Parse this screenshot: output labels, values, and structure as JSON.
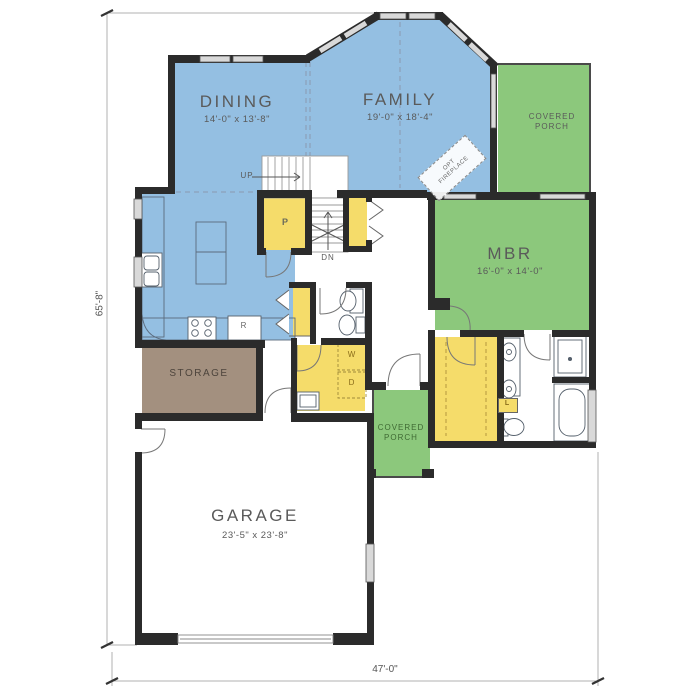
{
  "plan": {
    "rooms": {
      "dining": {
        "name": "DINING",
        "dims": "14'-0\" x 13'-8\""
      },
      "family": {
        "name": "FAMILY",
        "dims": "19'-0\" x 18'-4\""
      },
      "covered_porch_upper": {
        "name": "COVERED\nPORCH"
      },
      "covered_porch_lower": {
        "name": "COVERED\nPORCH"
      },
      "mbr": {
        "name": "MBR",
        "dims": "16'-0\" x 14'-0\""
      },
      "storage": {
        "name": "STORAGE"
      },
      "garage": {
        "name": "GARAGE",
        "dims": "23'-5\" x 23'-8\""
      }
    },
    "labels": {
      "up": "UP",
      "dn": "DN",
      "pantry": "P",
      "refrigerator": "R",
      "washer": "W",
      "dryer": "D",
      "linen": "L",
      "fireplace_line1": "OPT",
      "fireplace_line2": "FIREPLACE"
    },
    "dimensions": {
      "overall_width": "47'-0\"",
      "overall_height": "65'-8\""
    },
    "colors": {
      "living": "#94bfe2",
      "outdoor": "#8cc87c",
      "closet": "#f5dc6a",
      "storage": "#a3907f",
      "wall": "#2b2b2b"
    }
  }
}
